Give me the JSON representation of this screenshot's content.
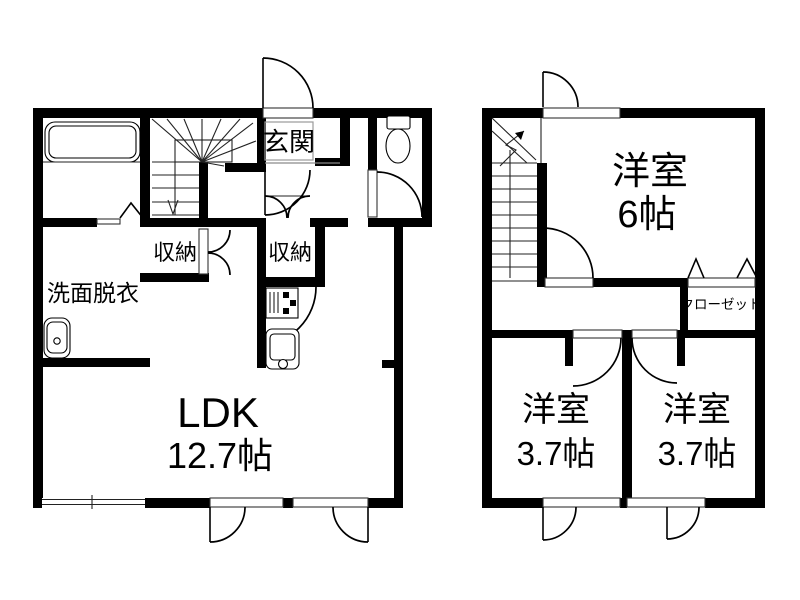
{
  "document": {
    "type": "japanese-apartment-floor-plan",
    "floors": "2"
  },
  "floor1": {
    "entrance_label": "玄関",
    "storage_under_stairs_label": "収納",
    "storage_hall_label": "収納",
    "washroom_label": "洗面脱衣",
    "ldk_label": "LDK",
    "ldk_size": "12.7帖"
  },
  "floor2": {
    "bedroom_main_label": "洋室",
    "bedroom_main_size": "6帖",
    "closet_label": "クローゼット",
    "bedroom_left_label": "洋室",
    "bedroom_left_size": "3.7帖",
    "bedroom_right_label": "洋室",
    "bedroom_right_size": "3.7帖"
  },
  "icons": {
    "bathtub": "bathtub-icon",
    "wash_basin": "wash-basin-icon",
    "toilet": "toilet-icon",
    "gas_stove": "gas-stove-icon",
    "kitchen_sink": "kitchen-sink-icon",
    "stairs_down_arrow": "stairs-down-arrow",
    "stairs_up_arrow": "stairs-up-arrow"
  },
  "colors": {
    "wall": "#000000",
    "background": "#ffffff",
    "threshold_gray": "#8a8a8a"
  }
}
